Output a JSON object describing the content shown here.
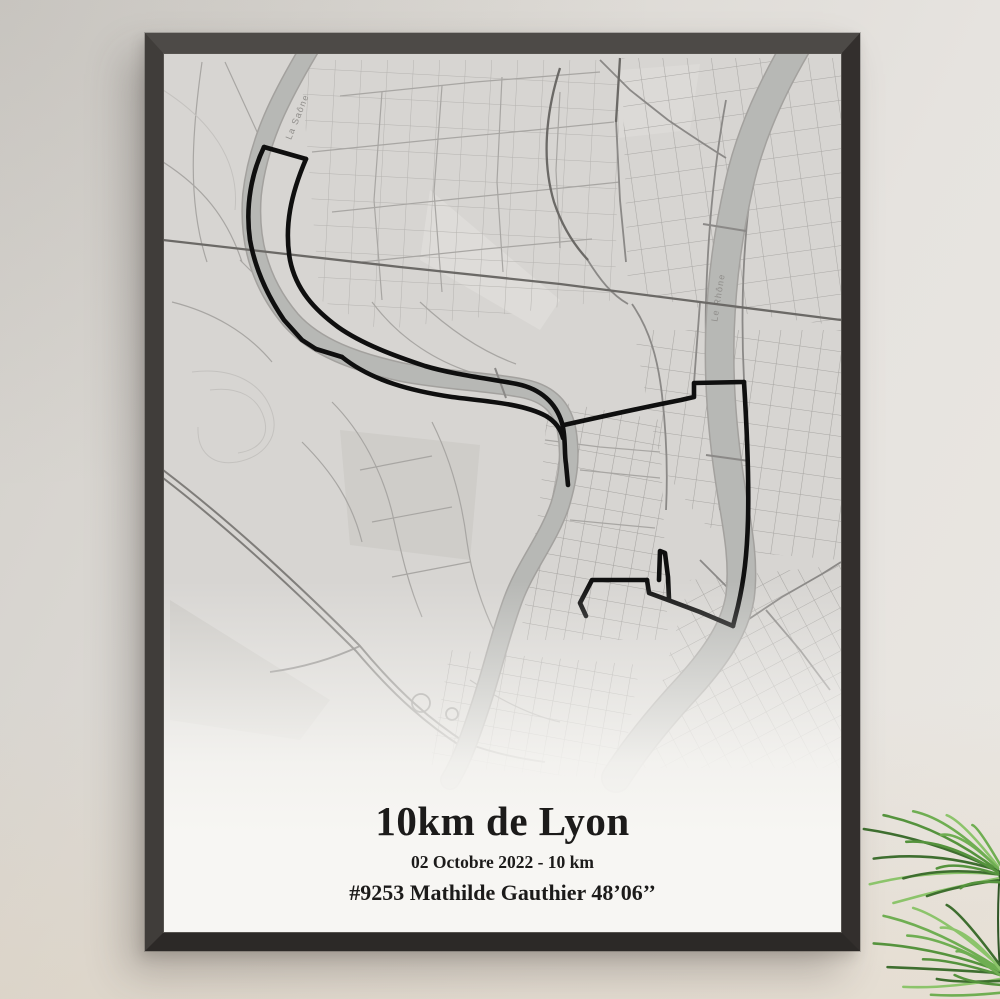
{
  "poster": {
    "title": "10km de Lyon",
    "subtitle": "02 Octobre 2022 - 10 km",
    "runner": "#9253 Mathilde Gauthier 48’06’’",
    "background": "#f6f5f2",
    "text_color": "#1c1b1a"
  },
  "frame": {
    "face_color": "#3d3a37"
  },
  "map": {
    "colors": {
      "background": "#d7d5d2",
      "water": "#b7b8b5",
      "water_edge": "#a3a19e",
      "route": "#0f0f0f",
      "street_thin": "#a8a6a3",
      "street_dark": "#6b6966"
    },
    "labels": [
      {
        "text": "La Saône",
        "x": 300,
        "y": 118,
        "rotate": -68
      },
      {
        "text": "Le Rhône",
        "x": 721,
        "y": 298,
        "rotate": -81
      }
    ],
    "rivers": [
      {
        "name": "Saône",
        "width": 17,
        "d": "M310,48 C282,95 258,140 252,195 C248,245 262,286 291,320 C316,348 356,362 401,372 C441,380 491,382 521,388 C549,393 563,408 567,432 C571,458 568,478 560,505 C548,540 526,565 513,600 C499,638 492,672 479,710 C469,740 461,762 450,780"
      },
      {
        "name": "Rhône",
        "width": 27,
        "d": "M800,40 C776,80 751,130 739,185 C729,230 722,275 720,330 C718,385 723,440 732,495 C739,535 744,565 740,597 C735,628 716,656 689,686 C663,714 636,746 616,778"
      }
    ],
    "route": {
      "width": 4.6,
      "segments": [
        "M264,147 L306,159",
        "M264,147 C252,172 245,205 250,240 C255,268 267,295 284,320 L302,340 L316,349",
        "M316,349 L342,357",
        "M342,357 C372,381 412,391 452,397 C482,401 522,403 546,416 C556,422 561,430 563,438",
        "M306,159 C291,194 284,226 290,260 C296,290 315,310 338,327 C362,344 395,356 425,366 C455,375 492,379 517,384 C541,389 556,403 562,423 C566,438 564,452 566,464 L568,485",
        "M564,425 C600,417 650,406 681,400 L694,397 L694,383 L744,382",
        "M744,382 C747,430 749,480 748,520 C747,555 744,580 738,606 L733,626",
        "M733,626 L700,612 L668,600 L649,593 L647,580",
        "M647,580 L592,580 L580,603 L586,616",
        "M659,580 L660,551 L665,553 L668,577 L669,599"
      ]
    }
  },
  "plant": {
    "colors": [
      "#3e6e2f",
      "#55933d",
      "#6fae52",
      "#8cc46b"
    ],
    "stem_color": "#2f5526"
  }
}
